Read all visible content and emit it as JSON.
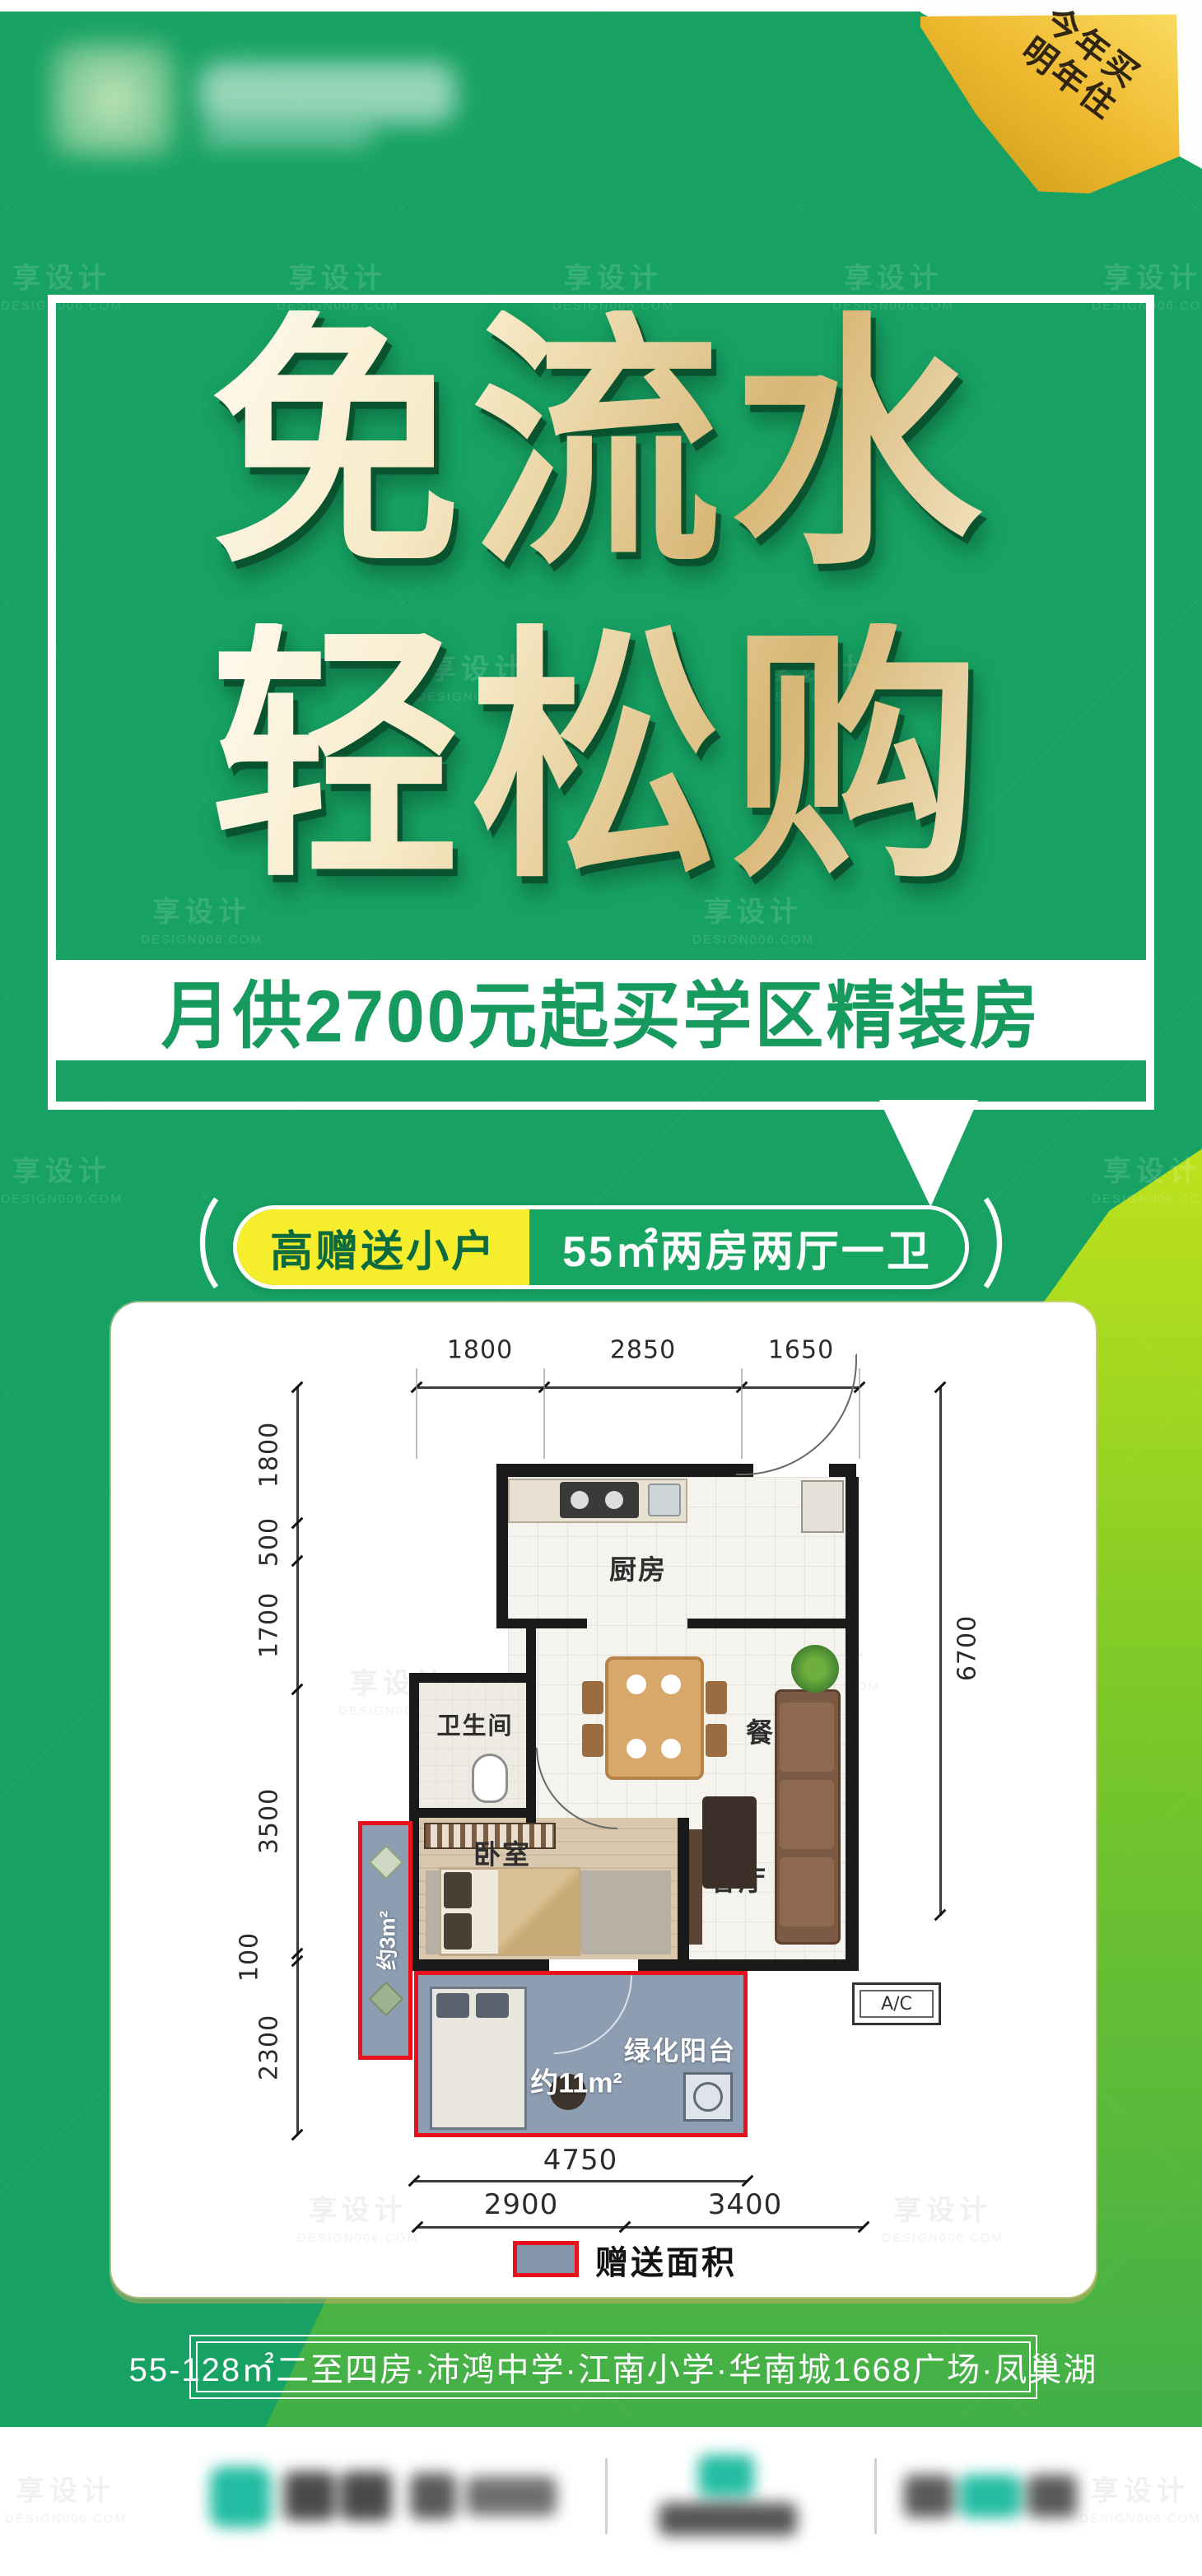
{
  "watermark": {
    "brand": "享设计",
    "domain": "DESIGN006.COM"
  },
  "corner_fold": {
    "line1": "今年买",
    "line2": "明年住"
  },
  "title": {
    "line1": "免流水",
    "line2": "轻松购"
  },
  "subtitle": "月供2700元起买学区精装房",
  "badge": {
    "open_paren": "（",
    "left": "高赠送小户",
    "right": "55㎡两房两厅一卫",
    "close_paren": "）"
  },
  "floor_plan": {
    "dims_top": [
      "1800",
      "2850",
      "1650"
    ],
    "dims_left": [
      "1800",
      "500",
      "1700",
      "3500",
      "100",
      "2300"
    ],
    "dim_right": "6700",
    "dim_balcony_width": "4750",
    "dims_bottom": [
      "2900",
      "3400"
    ],
    "rooms": {
      "kitchen": "厨房",
      "bathroom": "卫生间",
      "dining": "餐厅",
      "bedroom": "卧室",
      "living": "客厅",
      "balcony": "绿化阳台"
    },
    "gift_small_label": "约3m²",
    "gift_balcony_label": "约11m²",
    "ac_label": "A/C",
    "legend_label": "赠送面积"
  },
  "info_bar": "55-128㎡二至四房·沛鸿中学·江南小学·华南城1668广场·凤巢湖",
  "colors": {
    "background_green": "#17a263",
    "gradient_light_green": "#b9e01c",
    "fold_gold": "#eebc3a",
    "pill_yellow": "#f6ee2d",
    "highlight_red": "#e8111c",
    "gift_area_fill": "#8495ab",
    "subtitle_green": "#169a5e",
    "title_gold": "#e3c98f"
  }
}
